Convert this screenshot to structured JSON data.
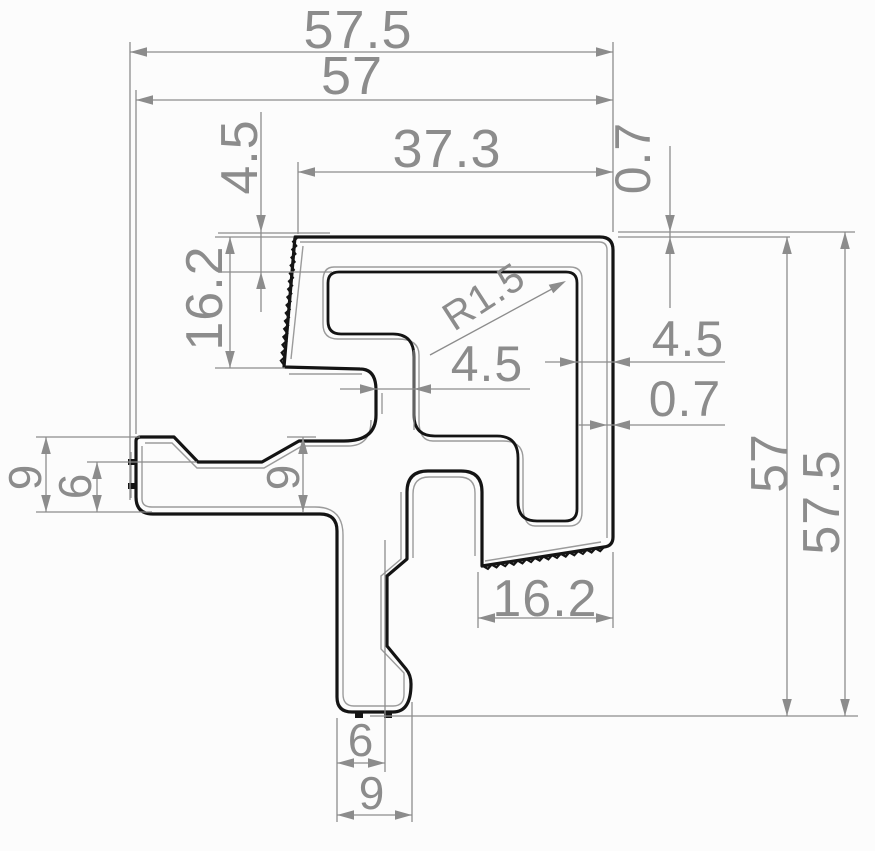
{
  "drawing": {
    "background": "#fcfcfc",
    "profile_color": "#141414",
    "companion_color": "#9b9b9b",
    "dimension_color": "#8c8c8c",
    "profile_paths": {
      "outer": "M 295,237 L 600,237 Q 613,237 613,250 L 613,537 Q 613,546 604,547 L 482,566 L 482,492 Q 482,471 461,471 L 428,471 Q 407,471 407,492 L 407,559 L 387,576 L 387,646 L 406,669 Q 411,675 411,684 Q 411,712 393,712 L 352,712 Q 337,712 337,697 L 337,531 Q 337,514 320,514 L 153,514 Q 136,514 136,497 L 136,441 Q 136,437 141,437 L 174,437 L 198,462 L 262,462 L 299,441 L 344,441 Q 376,441 376,415 L 376,390 Q 376,369 360,369 L 284,367 Z",
      "cavity": "M 339,272 L 566,272 Q 577,272 577,283 L 577,509 Q 577,521 565,521 L 537,521 Q 518,521 518,502 L 518,458 Q 518,436 497,436 L 435,436 Q 414,436 414,415 L 414,357 Q 414,334 393,334 L 341,334 Q 328,334 328,321 L 328,283 Q 328,272 339,272 Z"
    },
    "companion_paths": [
      "M 300,242 L 599,242 Q 607,242 607,250 L 607,538",
      "M 601,542 L 485,561",
      "M 303,246 L 291,359",
      "M 289,374 L 362,374",
      "M 382,393 L 382,414",
      "M 371,420 Q 371,446 348,446 L 302,446 L 264,468 L 197,468 L 172,443 L 145,443",
      "M 142,446 L 142,499 Q 142,507 152,507 L 315,507 Q 343,507 343,535 L 343,694 Q 343,706 354,706 L 393,706 Q 404,706 404,694 L 404,673 L 381,649 L 381,576 L 401,559 L 401,492",
      "M 413,558 L 413,494 Q 413,477 429,477 L 459,477 Q 475,477 475,493 L 475,556",
      "M 334,267 L 570,267 Q 582,267 582,279 L 582,512 Q 582,526 569,526 L 535,526 Q 523,526 523,505 L 523,459 Q 523,441 503,441 L 433,441 Q 419,441 419,421 L 419,355 Q 419,339 398,339 L 338,339 Q 323,339 323,324 L 323,281 Q 323,267 334,267 Z",
      "M 131,452 L 131,498"
    ],
    "serrated_edges": [
      {
        "x1": 297,
        "y1": 238,
        "x2": 284,
        "y2": 365,
        "teeth": 16,
        "amp": 3.5,
        "flip": true
      },
      {
        "x1": 604,
        "y1": 547,
        "x2": 483,
        "y2": 566,
        "teeth": 14,
        "amp": 3.5,
        "flip": false
      }
    ],
    "rib_marks": [
      [
        128,
        459,
        9,
        6
      ],
      [
        128,
        483,
        9,
        6
      ],
      [
        355,
        712,
        8,
        6
      ],
      [
        384,
        712,
        8,
        6
      ]
    ],
    "dimensions": [
      {
        "name": "57-5-top",
        "label": "57.5",
        "tx": 358,
        "ty": 30,
        "rot": 0,
        "fs": 54,
        "lines": [
          [
            130,
            52,
            613,
            52
          ],
          [
            130,
            42,
            130,
            500
          ],
          [
            613,
            42,
            613,
            232
          ]
        ],
        "arrows": [
          [
            130,
            52,
            180
          ],
          [
            613,
            52,
            0
          ]
        ]
      },
      {
        "name": "57-top",
        "label": "57",
        "tx": 352,
        "ty": 76,
        "rot": 0,
        "fs": 54,
        "lines": [
          [
            136,
            100,
            613,
            100
          ],
          [
            136,
            90,
            136,
            434
          ]
        ],
        "arrows": [
          [
            136,
            100,
            180
          ],
          [
            613,
            100,
            0
          ]
        ]
      },
      {
        "name": "37-3-top",
        "label": "37.3",
        "tx": 447,
        "ty": 149,
        "rot": 0,
        "fs": 54,
        "lines": [
          [
            298,
            172,
            613,
            172
          ],
          [
            298,
            162,
            298,
            234
          ]
        ],
        "arrows": [
          [
            298,
            172,
            180
          ],
          [
            613,
            172,
            0
          ]
        ]
      },
      {
        "name": "4-5-left",
        "label": "4.5",
        "tx": 240,
        "ty": 157,
        "rot": -90,
        "fs": 52,
        "lines": [
          [
            261,
            112,
            261,
            312
          ],
          [
            218,
            233,
            330,
            233
          ],
          [
            218,
            272,
            332,
            272
          ]
        ],
        "arrows": [
          [
            261,
            232,
            90
          ],
          [
            261,
            272,
            -90
          ]
        ]
      },
      {
        "name": "16-2-left",
        "label": "16.2",
        "tx": 205,
        "ty": 298,
        "rot": -90,
        "fs": 52,
        "lines": [
          [
            230,
            237,
            230,
            368
          ],
          [
            215,
            237,
            293,
            237
          ],
          [
            215,
            368,
            285,
            368
          ]
        ],
        "arrows": [
          [
            230,
            237,
            -90
          ],
          [
            230,
            368,
            90
          ]
        ]
      },
      {
        "name": "r1-5",
        "label": "R1.5",
        "tx": 484,
        "ty": 297,
        "rot": -33,
        "fs": 40,
        "lines": [
          [
            430,
            355,
            563,
            283
          ]
        ],
        "arrows": [
          [
            566,
            281,
            -28
          ]
        ]
      },
      {
        "name": "4-5-mid",
        "label": "4.5",
        "tx": 487,
        "ty": 364,
        "rot": 0,
        "fs": 50,
        "lines": [
          [
            340,
            389,
            530,
            389
          ],
          [
            414,
            350,
            414,
            430
          ]
        ],
        "arrows": [
          [
            377,
            389,
            0
          ],
          [
            414,
            389,
            180
          ]
        ]
      },
      {
        "name": "4-5-right",
        "label": "4.5",
        "tx": 688,
        "ty": 339,
        "rot": 0,
        "fs": 50,
        "lines": [
          [
            545,
            362,
            725,
            362
          ]
        ],
        "arrows": [
          [
            577,
            362,
            0
          ],
          [
            613,
            362,
            180
          ]
        ]
      },
      {
        "name": "0-7-right",
        "label": "0.7",
        "tx": 685,
        "ty": 399,
        "rot": 0,
        "fs": 50,
        "lines": [
          [
            578,
            425,
            725,
            425
          ]
        ],
        "arrows": [
          [
            607,
            425,
            0
          ],
          [
            613,
            425,
            180
          ]
        ]
      },
      {
        "name": "0-7-top",
        "label": "0.7",
        "tx": 633,
        "ty": 158,
        "rot": -90,
        "fs": 50,
        "lines": [
          [
            670,
            146,
            670,
            308
          ],
          [
            618,
            232,
            855,
            232
          ],
          [
            618,
            237,
            790,
            237
          ]
        ],
        "arrows": [
          [
            670,
            232,
            90
          ],
          [
            670,
            237,
            -90
          ]
        ]
      },
      {
        "name": "57-right",
        "label": "57",
        "tx": 770,
        "ty": 463,
        "rot": -90,
        "fs": 52,
        "lines": [
          [
            787,
            237,
            787,
            716
          ]
        ],
        "arrows": [
          [
            787,
            237,
            -90
          ],
          [
            787,
            716,
            90
          ]
        ]
      },
      {
        "name": "57-5-right",
        "label": "57.5",
        "tx": 822,
        "ty": 502,
        "rot": -90,
        "fs": 52,
        "lines": [
          [
            845,
            232,
            845,
            716
          ],
          [
            370,
            716,
            858,
            716
          ]
        ],
        "arrows": [
          [
            845,
            232,
            -90
          ],
          [
            845,
            716,
            90
          ]
        ]
      },
      {
        "name": "16-2-bottom",
        "label": "16.2",
        "tx": 545,
        "ty": 599,
        "rot": 0,
        "fs": 52,
        "lines": [
          [
            478,
            618,
            613,
            618
          ],
          [
            478,
            572,
            478,
            628
          ],
          [
            613,
            552,
            613,
            628
          ]
        ],
        "arrows": [
          [
            478,
            618,
            180
          ],
          [
            613,
            618,
            0
          ]
        ]
      },
      {
        "name": "9-mid",
        "label": "9",
        "tx": 283,
        "ty": 477,
        "rot": -90,
        "fs": 46,
        "lines": [
          [
            303,
            437,
            303,
            512
          ],
          [
            287,
            437,
            316,
            437
          ]
        ],
        "arrows": [
          [
            303,
            437,
            -90
          ],
          [
            303,
            512,
            90
          ]
        ]
      },
      {
        "name": "9-left",
        "label": "9",
        "tx": 25,
        "ty": 477,
        "rot": -90,
        "fs": 46,
        "lines": [
          [
            46,
            437,
            46,
            512
          ],
          [
            36,
            437,
            140,
            437
          ],
          [
            36,
            512,
            152,
            512
          ]
        ],
        "arrows": [
          [
            46,
            437,
            -90
          ],
          [
            46,
            512,
            90
          ]
        ]
      },
      {
        "name": "6-left",
        "label": "6",
        "tx": 75,
        "ty": 486,
        "rot": -90,
        "fs": 46,
        "lines": [
          [
            97,
            462,
            97,
            512
          ],
          [
            87,
            462,
            197,
            462
          ]
        ],
        "arrows": [
          [
            97,
            462,
            -90
          ],
          [
            97,
            512,
            90
          ]
        ]
      },
      {
        "name": "6-bottom",
        "label": "6",
        "tx": 361,
        "ty": 740,
        "rot": 0,
        "fs": 46,
        "lines": [
          [
            337,
            763,
            385,
            763
          ],
          [
            337,
            718,
            337,
            822
          ],
          [
            385,
            540,
            385,
            772
          ]
        ],
        "arrows": [
          [
            337,
            763,
            180
          ],
          [
            385,
            763,
            0
          ]
        ]
      },
      {
        "name": "9-bottom",
        "label": "9",
        "tx": 372,
        "ty": 793,
        "rot": 0,
        "fs": 46,
        "lines": [
          [
            337,
            815,
            412,
            815
          ],
          [
            412,
            702,
            412,
            822
          ]
        ],
        "arrows": [
          [
            337,
            815,
            180
          ],
          [
            412,
            815,
            0
          ]
        ]
      }
    ]
  }
}
